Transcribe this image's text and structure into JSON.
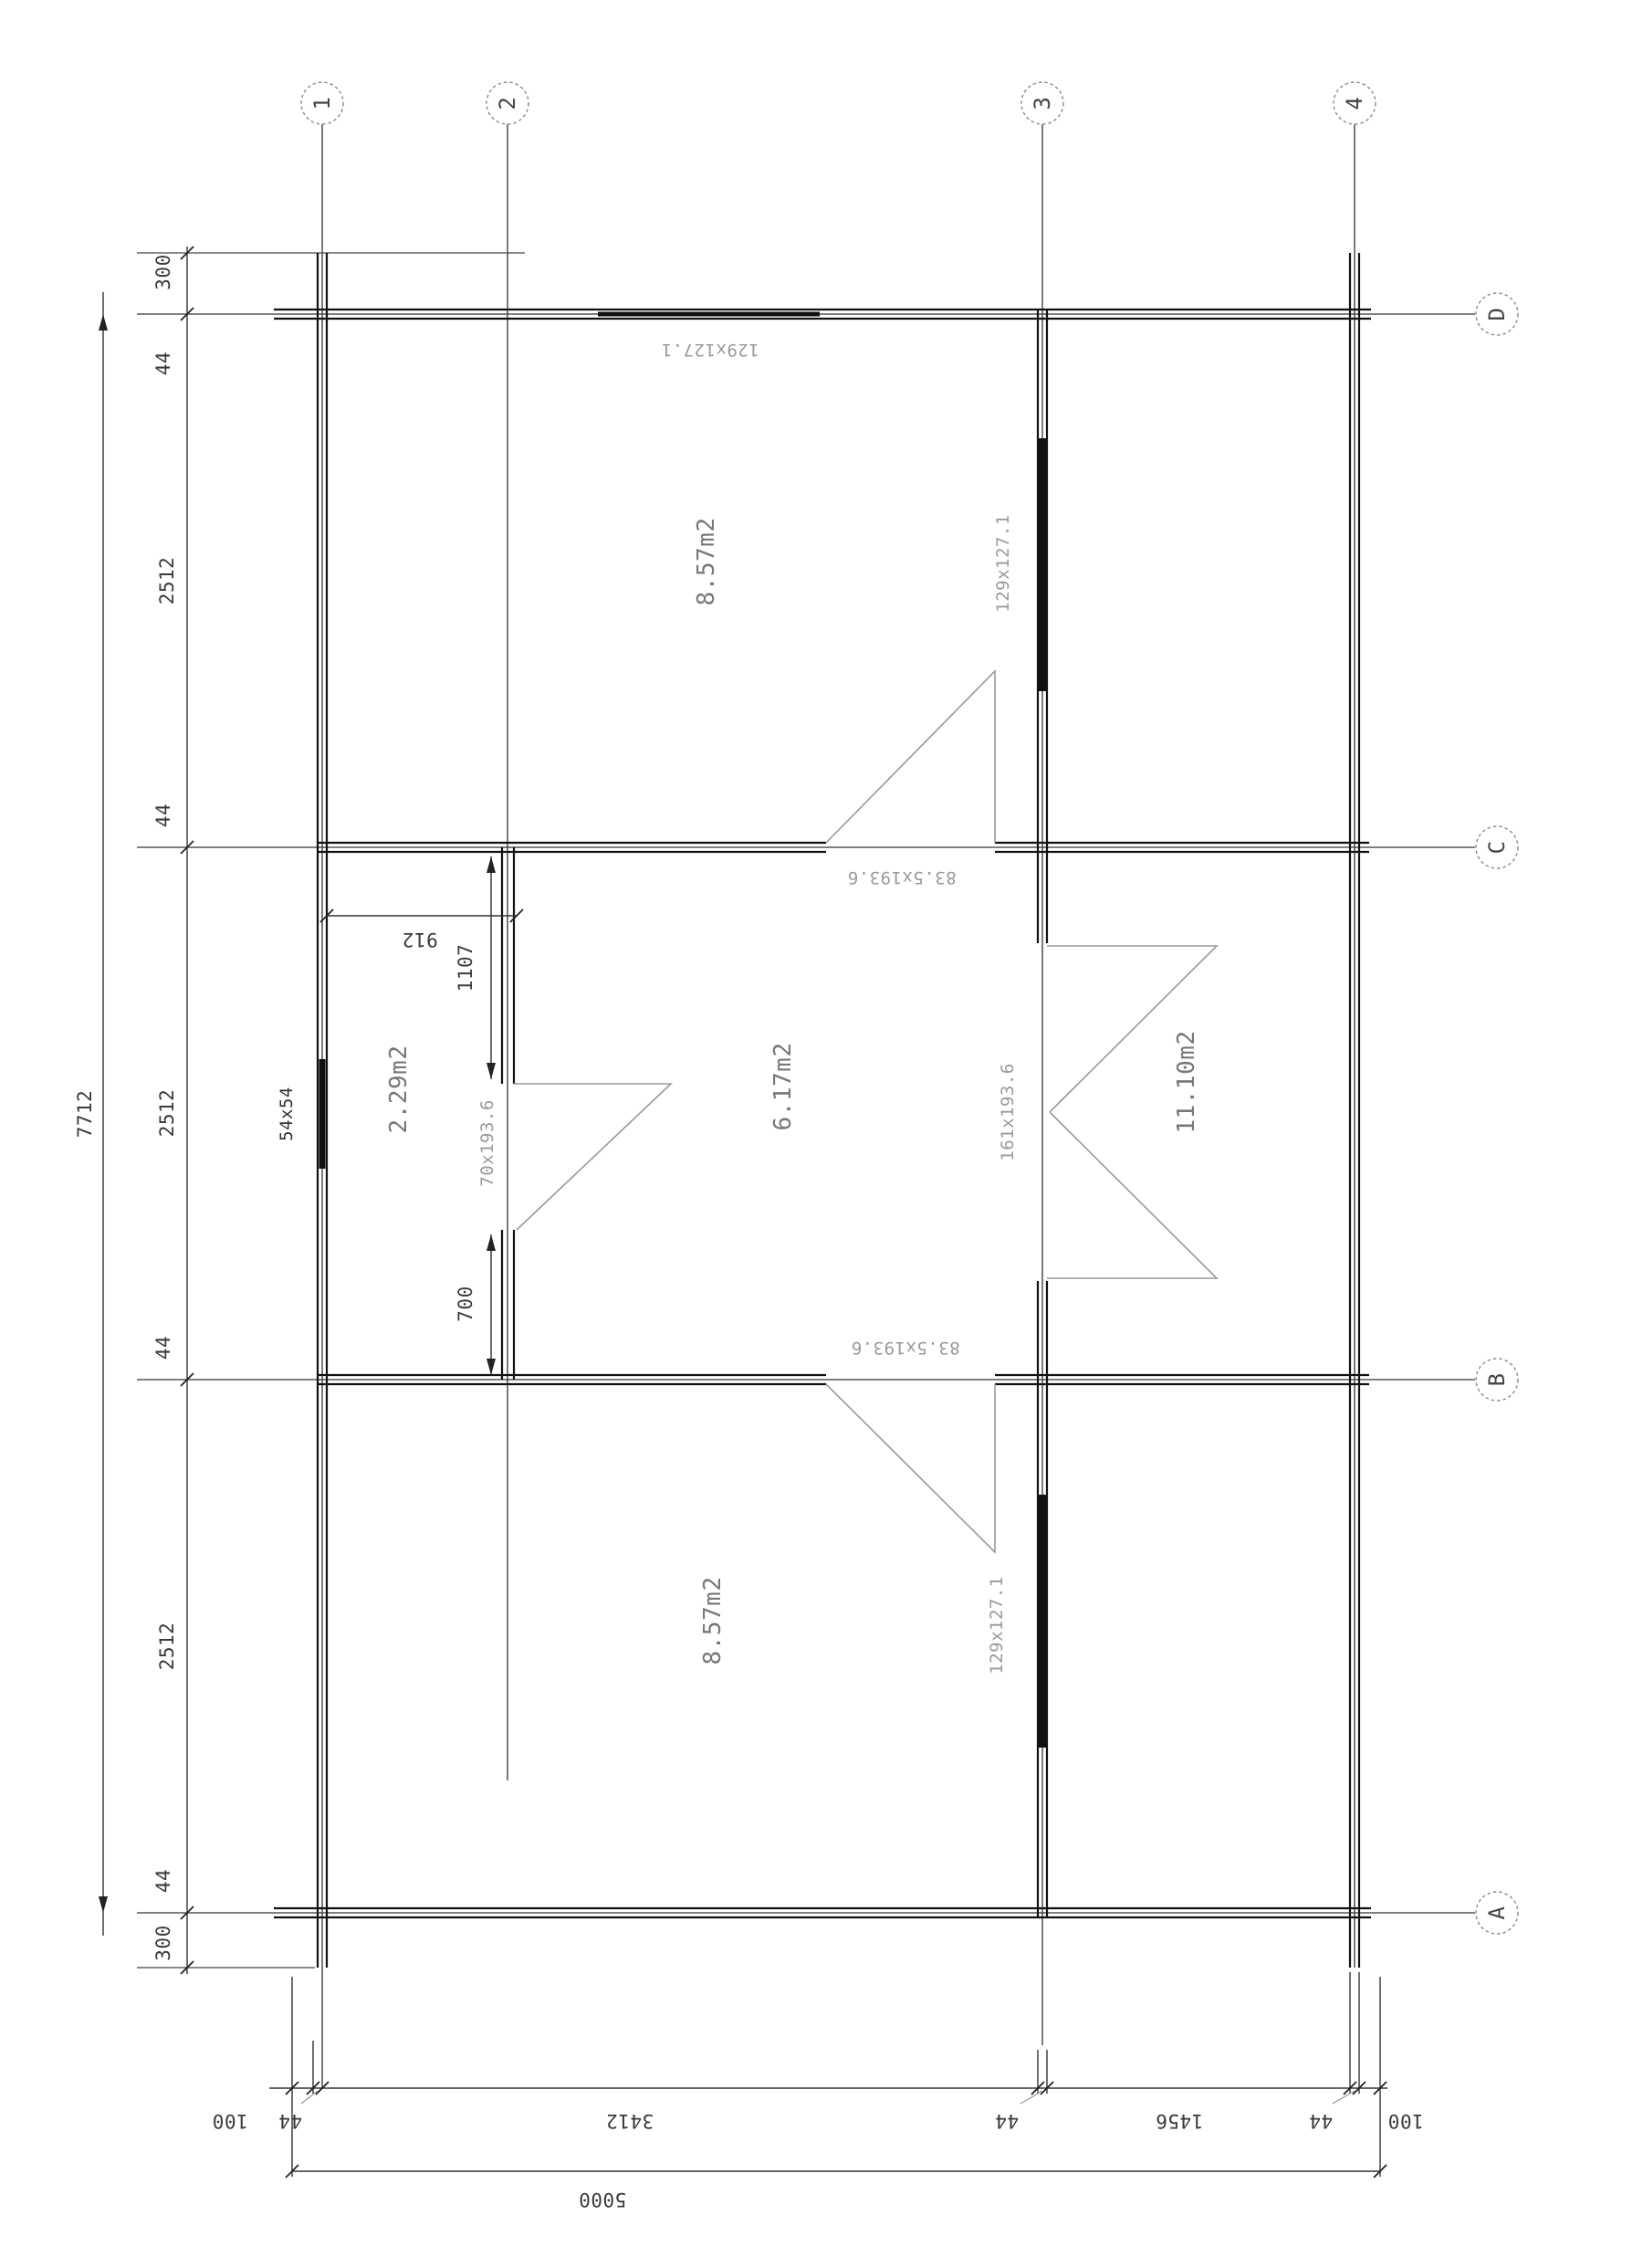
{
  "axes": {
    "cols": [
      "1",
      "2",
      "3",
      "4"
    ],
    "rows": [
      "D",
      "C",
      "B",
      "A"
    ]
  },
  "dims": {
    "left_outer_total": "7712",
    "left_chain": {
      "top_300": "300",
      "top_44": "44",
      "seg_dc": "2512",
      "c_44": "44",
      "seg_cb": "2512",
      "b_44": "44",
      "seg_ba": "2512",
      "a_44": "44",
      "bot_300": "300"
    },
    "partition": {
      "w912": "912",
      "h1107": "1107",
      "h700": "700"
    },
    "bottom_chain": {
      "l100": "100",
      "w44_1": "44",
      "span13": "3412",
      "w44_3": "44",
      "span34": "1456",
      "w44_4": "44",
      "r100": "100"
    },
    "overall_width": "5000"
  },
  "openings": {
    "window_d": "129x127.1",
    "window_3_top": "129x127.1",
    "window_3_bottom": "129x127.1",
    "door_c": "83.5x193.6",
    "door_b": "83.5x193.6",
    "door_3": "161x193.6",
    "door_2": "70x193.6",
    "post": "54x54"
  },
  "rooms": {
    "top": "8.57m2",
    "closet": "2.29m2",
    "middle": "6.17m2",
    "right": "11.10m2",
    "bottom": "8.57m2"
  },
  "colors": {
    "wall": "#111111",
    "grid": "#333333",
    "swing": "#999999",
    "label_gray": "#9a9a9a"
  }
}
